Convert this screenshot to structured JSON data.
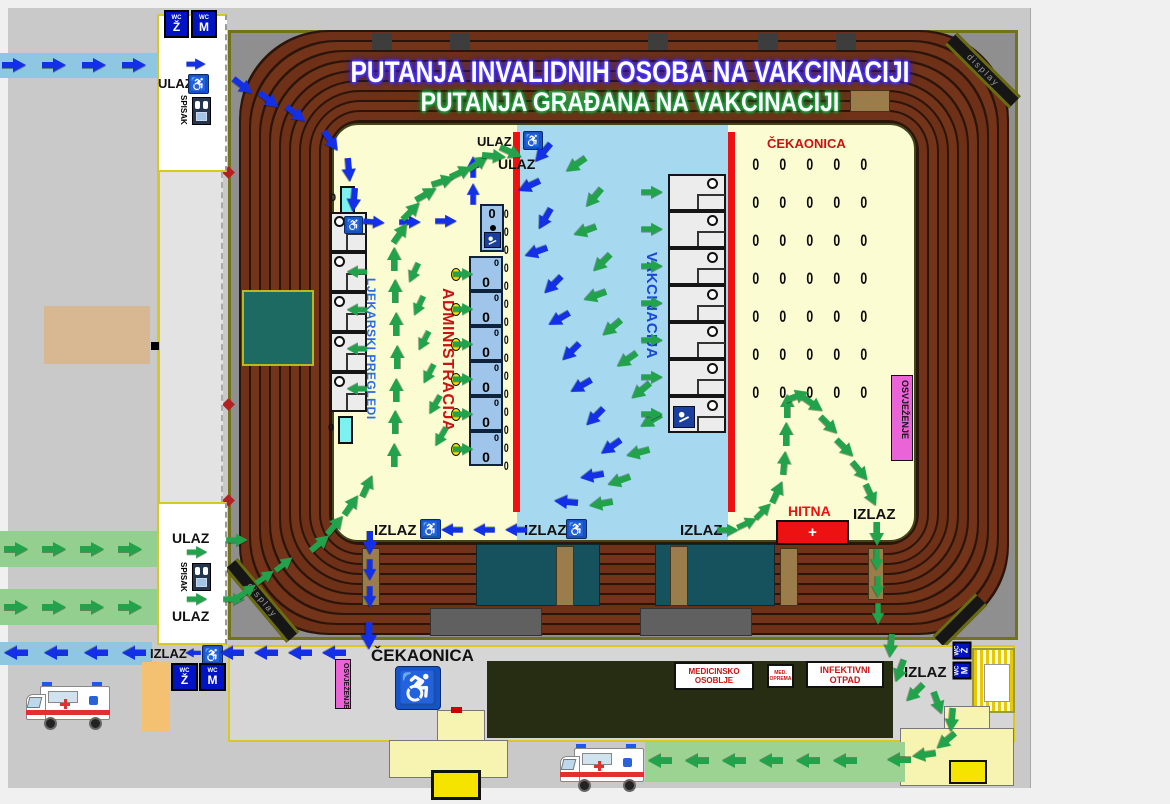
{
  "titles": {
    "line1": "PUTANJA INVALIDNIH OSOBA NA VAKCINACIJI",
    "line2": "PUTANJA GRAĐANA NA VAKCINACIJI"
  },
  "labels": {
    "ulaz": "ULAZ",
    "izlaz": "IZLAZ",
    "spisak": "SPISAK",
    "cekaonica": "ČEKAONICA",
    "ljekarski_pregledi": "LJEKARSKI PREGLEDI",
    "administracija": "ADMINISTRACIJA",
    "vakcinacija": "VAKCINACIJA",
    "osvjezenje": "OSVJEŽENJE",
    "hitna": "HITNA",
    "hitna_plus": "+",
    "medicinsko_osoblje": "MEDICINSKO OSOBLJE",
    "med_oprema": "MED. OPREMA",
    "infektivni_otpad": "INFEKTIVNI OTPAD",
    "display": "display",
    "wc": "WC",
    "wc_z": "Ž",
    "wc_m": "M",
    "chair": "0",
    "wheelchair_icon": "♿"
  },
  "colors": {
    "blue_path": "#1430e6",
    "green_path": "#23a24c",
    "field_yellow": "#fcfcd2",
    "vacc_blue_zone": "#a6d9ef",
    "red_divider": "#ee1111",
    "osvjezenje_pink": "#ea64d8",
    "hitna_red": "#ee1111",
    "wc_blue": "#0013c2",
    "seat_brown": "#703218"
  },
  "waiting_area": {
    "rows": 7,
    "cols": 5
  },
  "booths": {
    "ljekarski": 5,
    "administracija": 6,
    "vakcinacija": 7,
    "admin_side_chairs": 15,
    "admin_ovals": 6
  },
  "arrows": {
    "blue": [
      [
        14,
        65,
        0
      ],
      [
        54,
        65,
        0
      ],
      [
        94,
        65,
        0
      ],
      [
        134,
        65,
        0
      ],
      [
        196,
        64,
        0,
        0.8
      ],
      [
        243,
        86,
        38
      ],
      [
        269,
        100,
        38
      ],
      [
        296,
        114,
        38
      ],
      [
        331,
        141,
        55
      ],
      [
        349,
        170,
        85
      ],
      [
        354,
        200,
        95
      ],
      [
        374,
        222,
        5,
        0.9
      ],
      [
        410,
        222,
        0,
        0.9
      ],
      [
        446,
        221,
        0,
        0.9
      ],
      [
        473,
        194,
        -90,
        0.9
      ],
      [
        473,
        167,
        -90,
        0.9
      ],
      [
        543,
        153,
        130
      ],
      [
        529,
        186,
        155
      ],
      [
        545,
        219,
        120
      ],
      [
        536,
        252,
        160
      ],
      [
        553,
        285,
        135
      ],
      [
        559,
        319,
        150
      ],
      [
        571,
        352,
        135
      ],
      [
        581,
        386,
        150
      ],
      [
        595,
        417,
        135
      ],
      [
        611,
        447,
        145
      ],
      [
        592,
        476,
        170
      ],
      [
        566,
        502,
        185
      ],
      [
        516,
        530,
        180,
        0.9
      ],
      [
        484,
        530,
        180,
        0.9
      ],
      [
        452,
        530,
        180,
        0.9
      ],
      [
        370,
        543,
        90
      ],
      [
        370,
        570,
        90,
        0.9
      ],
      [
        370,
        597,
        90,
        0.9
      ],
      [
        369,
        636,
        90,
        1.15
      ],
      [
        334,
        653,
        180
      ],
      [
        300,
        653,
        180
      ],
      [
        266,
        653,
        180
      ],
      [
        232,
        653,
        180
      ],
      [
        193,
        653,
        180,
        0.65
      ],
      [
        134,
        653,
        180
      ],
      [
        96,
        653,
        180
      ],
      [
        56,
        653,
        180
      ],
      [
        16,
        653,
        180
      ]
    ],
    "green": [
      [
        16,
        549,
        0
      ],
      [
        54,
        549,
        0
      ],
      [
        92,
        549,
        0
      ],
      [
        130,
        549,
        0
      ],
      [
        16,
        607,
        0
      ],
      [
        54,
        607,
        0
      ],
      [
        92,
        607,
        0
      ],
      [
        130,
        607,
        0
      ],
      [
        197,
        552,
        0,
        0.85
      ],
      [
        197,
        599,
        0,
        0.85
      ],
      [
        237,
        540,
        0,
        0.9
      ],
      [
        234,
        599,
        0,
        0.9
      ],
      [
        247,
        591,
        -35,
        0.9
      ],
      [
        265,
        577,
        -35,
        0.9
      ],
      [
        284,
        564,
        -38,
        0.9
      ],
      [
        320,
        543,
        -40
      ],
      [
        335,
        525,
        -50
      ],
      [
        351,
        505,
        -55
      ],
      [
        367,
        486,
        -65
      ],
      [
        394,
        455,
        -90
      ],
      [
        395,
        422,
        -90
      ],
      [
        396,
        390,
        -90
      ],
      [
        397,
        357,
        -90
      ],
      [
        396,
        324,
        -90
      ],
      [
        395,
        291,
        -90
      ],
      [
        394,
        259,
        -90
      ],
      [
        414,
        273,
        115,
        0.9
      ],
      [
        419,
        306,
        115,
        0.9
      ],
      [
        424,
        341,
        118,
        0.9
      ],
      [
        429,
        374,
        118,
        0.9
      ],
      [
        435,
        405,
        120,
        0.9
      ],
      [
        441,
        437,
        120,
        0.9
      ],
      [
        357,
        272,
        180,
        0.85
      ],
      [
        357,
        310,
        180,
        0.85
      ],
      [
        357,
        349,
        180,
        0.85
      ],
      [
        357,
        389,
        180,
        0.85
      ],
      [
        463,
        274,
        0,
        0.85
      ],
      [
        463,
        309,
        0,
        0.85
      ],
      [
        463,
        344,
        0,
        0.85
      ],
      [
        463,
        379,
        0,
        0.85
      ],
      [
        463,
        414,
        0,
        0.85
      ],
      [
        463,
        449,
        0,
        0.85
      ],
      [
        400,
        233,
        -55
      ],
      [
        411,
        211,
        -45
      ],
      [
        426,
        194,
        -30
      ],
      [
        443,
        181,
        -18
      ],
      [
        461,
        172,
        -25
      ],
      [
        478,
        163,
        -35
      ],
      [
        494,
        156,
        5
      ],
      [
        511,
        152,
        25
      ],
      [
        576,
        165,
        145
      ],
      [
        594,
        198,
        130
      ],
      [
        585,
        231,
        160
      ],
      [
        602,
        263,
        135
      ],
      [
        595,
        296,
        160
      ],
      [
        612,
        328,
        140
      ],
      [
        627,
        360,
        145
      ],
      [
        641,
        391,
        140
      ],
      [
        651,
        421,
        150
      ],
      [
        638,
        453,
        165
      ],
      [
        619,
        481,
        160
      ],
      [
        601,
        504,
        170
      ],
      [
        652,
        192,
        0,
        0.9
      ],
      [
        652,
        229,
        0,
        0.9
      ],
      [
        652,
        266,
        0,
        0.9
      ],
      [
        652,
        303,
        0,
        0.9
      ],
      [
        652,
        340,
        0,
        0.9
      ],
      [
        652,
        377,
        0,
        0.9
      ],
      [
        652,
        414,
        0,
        0.9
      ],
      [
        728,
        530,
        0,
        0.9
      ],
      [
        747,
        523,
        -25,
        0.9
      ],
      [
        763,
        511,
        -45,
        0.9
      ],
      [
        777,
        492,
        -65
      ],
      [
        784,
        463,
        -85
      ],
      [
        786,
        434,
        -90
      ],
      [
        787,
        406,
        -90
      ],
      [
        797,
        396,
        -20
      ],
      [
        813,
        404,
        35
      ],
      [
        829,
        425,
        45
      ],
      [
        845,
        448,
        45
      ],
      [
        860,
        471,
        50
      ],
      [
        871,
        495,
        65
      ],
      [
        877,
        534,
        90
      ],
      [
        877,
        560,
        90,
        0.9
      ],
      [
        878,
        587,
        90,
        0.9
      ],
      [
        878,
        614,
        90,
        0.9
      ],
      [
        891,
        646,
        95
      ],
      [
        900,
        671,
        110
      ],
      [
        915,
        693,
        135
      ],
      [
        938,
        703,
        70
      ],
      [
        952,
        720,
        95
      ],
      [
        946,
        741,
        140
      ],
      [
        924,
        755,
        172
      ],
      [
        899,
        760,
        180
      ],
      [
        845,
        761,
        180
      ],
      [
        808,
        761,
        180
      ],
      [
        771,
        761,
        180
      ],
      [
        734,
        761,
        180
      ],
      [
        697,
        761,
        180
      ],
      [
        660,
        761,
        180
      ]
    ]
  }
}
